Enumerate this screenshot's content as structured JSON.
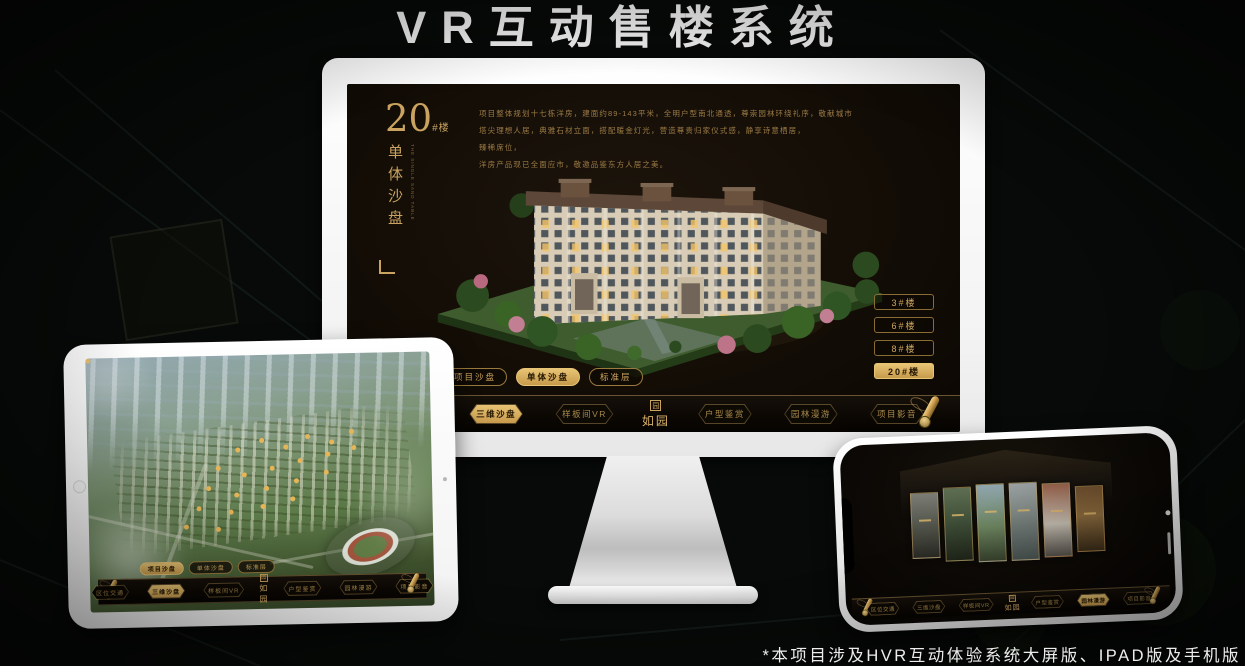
{
  "page": {
    "title": "VR互动售楼系统",
    "footnote": "*本项目涉及HVR互动体验系统大屏版、IPAD版及手机版"
  },
  "brand": {
    "logo_text": "如园",
    "seal_char": "园"
  },
  "colors": {
    "gold": "#c9a35f",
    "gold_active": "#d9b268",
    "screen_bg": "#130d06",
    "monitor_shell": "#f3f3f3"
  },
  "icons": {
    "nav_scroll": "scroll-roll-icon",
    "logo_seal": "seal-icon",
    "home_button": "ipad-home-button",
    "camera": "camera-dot"
  },
  "monitor": {
    "headline": {
      "number": "20",
      "suffix": "#楼",
      "subtitle": "单体沙盘",
      "subtitle_en": "THE SINGLE SAND TABLE"
    },
    "description_lines": [
      "项目整体规划十七栋洋房，建面约89-143平米，全明户型南北通透，尊崇园林环绕礼序，敬献城市",
      "塔尖理想人居，典雅石材立面，搭配暖金灯光，营造尊贵归家仪式感，静享诗意栖居，",
      "臻稀席位，",
      "洋房产品现已全面应市，敬邀品鉴东方人居之美。"
    ],
    "floor_buttons": [
      {
        "label": "3#楼",
        "active": false
      },
      {
        "label": "6#楼",
        "active": false
      },
      {
        "label": "8#楼",
        "active": false
      },
      {
        "label": "20#楼",
        "active": true
      }
    ],
    "view_tabs": [
      {
        "label": "项目沙盘",
        "active": false
      },
      {
        "label": "单体沙盘",
        "active": true
      },
      {
        "label": "标准层",
        "active": false
      }
    ],
    "nav": {
      "left": [
        {
          "label": "区位交通",
          "active": false
        },
        {
          "label": "三维沙盘",
          "active": true
        },
        {
          "label": "样板间VR",
          "active": false
        }
      ],
      "right": [
        {
          "label": "户型鉴赏",
          "active": false
        },
        {
          "label": "园林漫游",
          "active": false
        },
        {
          "label": "项目影音",
          "active": false
        }
      ]
    }
  },
  "ipad": {
    "view_tabs": [
      {
        "label": "项目沙盘",
        "active": true
      },
      {
        "label": "单体沙盘",
        "active": false
      },
      {
        "label": "标准层",
        "active": false
      }
    ],
    "nav": {
      "left": [
        {
          "label": "区位交通",
          "active": false
        },
        {
          "label": "三维沙盘",
          "active": true
        },
        {
          "label": "样板间VR",
          "active": false
        }
      ],
      "right": [
        {
          "label": "户型鉴赏",
          "active": false
        },
        {
          "label": "园林漫游",
          "active": false
        },
        {
          "label": "项目影音",
          "active": false
        }
      ]
    }
  },
  "phone": {
    "nav": {
      "left": [
        {
          "label": "区位交通",
          "active": false
        },
        {
          "label": "三维沙盘",
          "active": false
        },
        {
          "label": "样板间VR",
          "active": false
        }
      ],
      "right": [
        {
          "label": "户型鉴赏",
          "active": false
        },
        {
          "label": "园林漫游",
          "active": true
        },
        {
          "label": "项目影音",
          "active": false
        }
      ]
    }
  }
}
